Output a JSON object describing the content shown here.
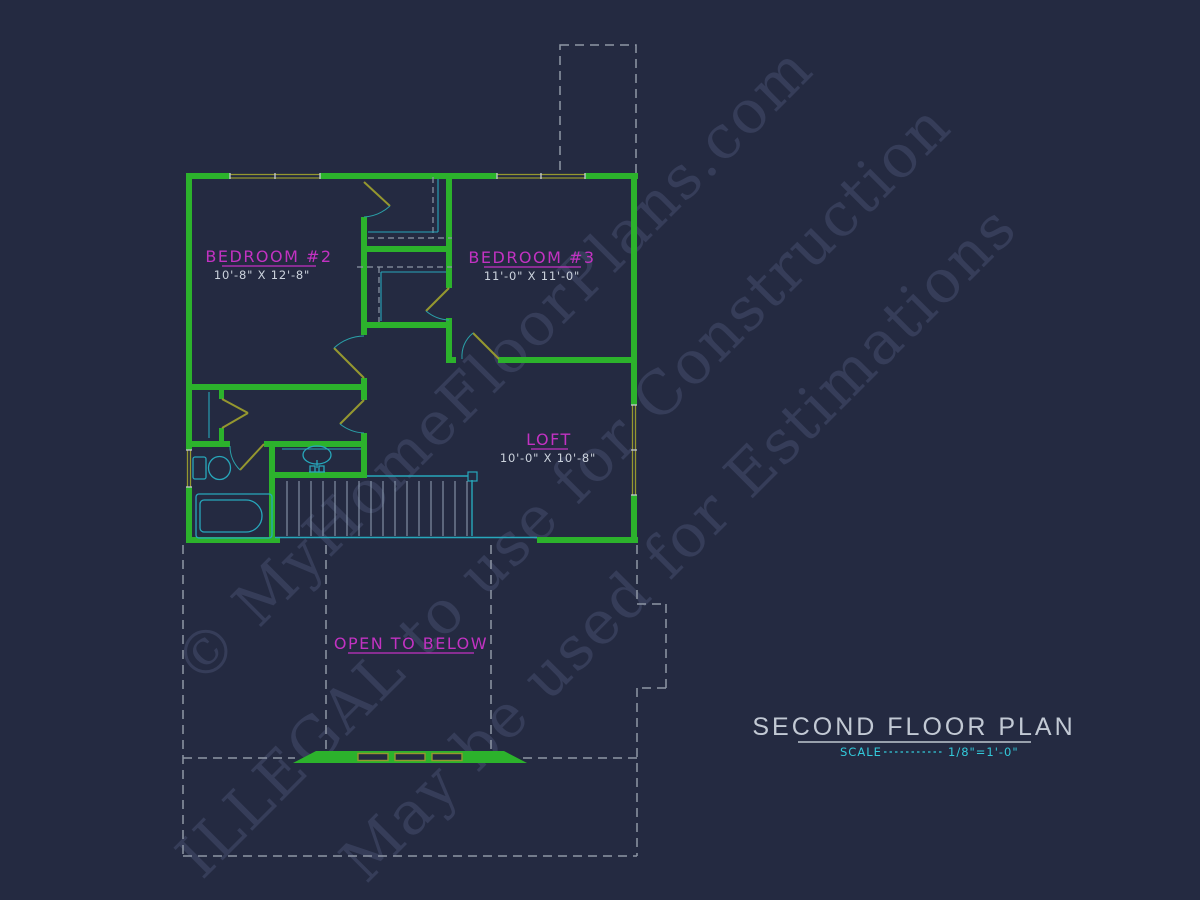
{
  "colors": {
    "background": "#242a41",
    "wall_green": "#2cb22c",
    "window_olive": "#95972f",
    "fixture_cyan": "#27a7bb",
    "label_magenta": "#c232c2",
    "dim_text": "#ccd3dd",
    "dashed_gray": "#8e97a6",
    "tread_gray": "#93a2b6",
    "title_gray": "#c2c9d4",
    "scale_cyan": "#33c9da",
    "watermark": "#38405c"
  },
  "watermarks": [
    "© MyHomeFloorPlans.com",
    "ILLEGAL to use for Construction",
    "May be used for Estimations"
  ],
  "rooms": {
    "bedroom2": {
      "name": "BEDROOM #2",
      "dims": "10'-8\" X 12'-8\""
    },
    "bedroom3": {
      "name": "BEDROOM #3",
      "dims": "11'-0\" X 11'-0\""
    },
    "loft": {
      "name": "LOFT",
      "dims": "10'-0\" X 10'-8\""
    }
  },
  "annotations": {
    "open_to_below": "OPEN TO BELOW"
  },
  "title_block": {
    "title": "SECOND FLOOR PLAN",
    "scale_label": "SCALE",
    "scale_value": "1/8\"=1'-0\""
  }
}
